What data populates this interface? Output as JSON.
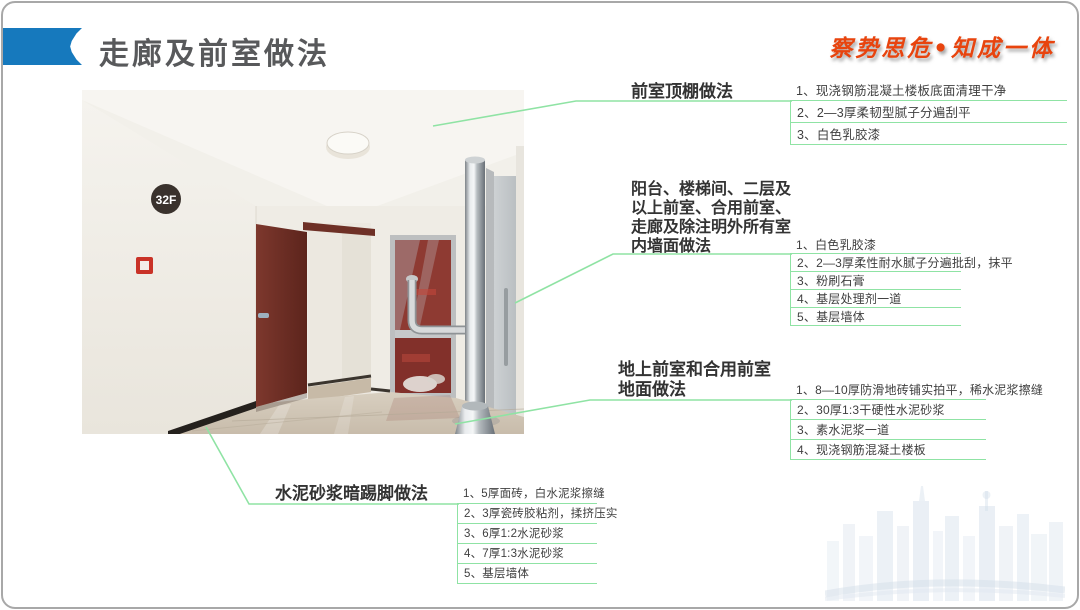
{
  "slide": {
    "title": "走廊及前室做法",
    "motto": "察势思危•知成一体"
  },
  "photo": {
    "floor_sign": "32F"
  },
  "annotations": [
    {
      "name": "ceiling",
      "title": "前室顶棚做法",
      "items": [
        "1、现浇钢筋混凝土楼板底面清理干净",
        "2、2—3厚柔韧型腻子分遍刮平",
        "3、白色乳胶漆"
      ]
    },
    {
      "name": "wall",
      "title": "阳台、楼梯间、二层及以上前室、合用前室、走廊及除注明外所有室内墙面做法",
      "items": [
        "1、白色乳胶漆",
        "2、2—3厚柔性耐水腻子分遍批刮，抹平",
        "3、粉刷石膏",
        "4、基层处理剂一道",
        "5、基层墙体"
      ]
    },
    {
      "name": "floor",
      "title": "地上前室和合用前室地面做法",
      "items": [
        "1、8—10厚防滑地砖铺实拍平，稀水泥浆擦缝",
        "2、30厚1:3干硬性水泥砂浆",
        "3、素水泥浆一道",
        "4、现浇钢筋混凝土楼板"
      ]
    },
    {
      "name": "skirting",
      "title": "水泥砂浆暗踢脚做法",
      "items": [
        "1、5厚面砖，白水泥浆擦缝",
        "2、3厚瓷砖胶粘剂，揉挤压实",
        "3、6厚1:2水泥砂浆",
        "4、7厚1:3水泥砂浆",
        "5、基层墙体"
      ]
    }
  ],
  "colors": {
    "accent_blue": "#1679bd",
    "leader_green": "#8fe3a4",
    "motto_orange": "#e8440e",
    "title_gray": "#58595b"
  }
}
